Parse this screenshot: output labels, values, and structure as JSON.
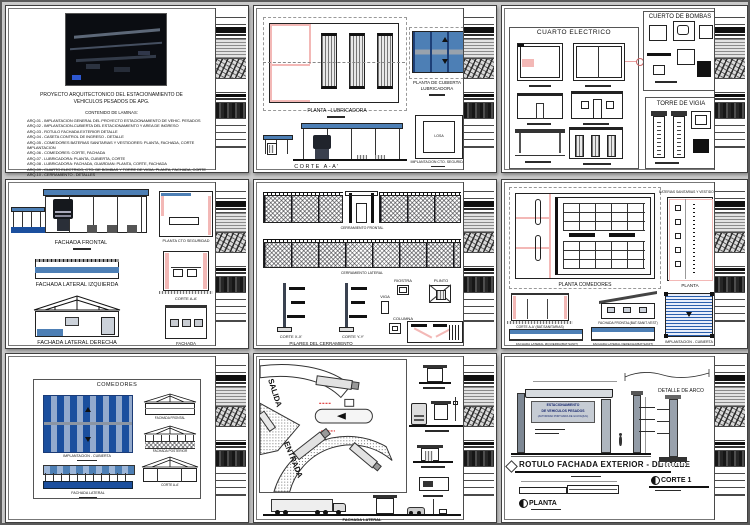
{
  "colors": {
    "roof_blue": "#4d7fb5",
    "stripe_dark": "#1b4f9e",
    "stripe_light": "#93aacd",
    "wall_pink": "#f3b8b6",
    "line": "#1a1a1a"
  },
  "s1": {
    "title1": "PROYECTO ARQUITECTONICO DEL ESTACIONAMIENTO DE",
    "title2": "VEHICULOS PESADOS DE APG.",
    "heading": "CONTENIDO DE LAMINAS:",
    "items": [
      "ARQ-01 - IMPLANTACION GENERAL DEL PROYECTO ESTACIONAMIENTO DE VEHIC. PESADOS",
      "ARQ-02 - IMPLANTACION-CUBIERTA DEL ESTACIONAMIENTO Y AREA DE INGRESO",
      "ARQ-03 - ROTULO FACHADA EXTERIOR DETALLE",
      "ARQ-04 - CASETA CONTROL DE INGRESO - DETALLE",
      "ARQ-05 - COMEDORES BATERIAS SANITARIAS Y VESTIDORES: PLANTA, FACHADA, CORTE IMPLANTACION",
      "ARQ-06 - COMEDORES: CORTE, FACHADA",
      "ARQ-07 - LUBRICADORA: PLANTA, CUBIERTA, CORTE",
      "ARQ-08 - LUBRICADORA: FACHADA, GUARDIAN: PLANTA, CORTE, FACHADA",
      "ARQ-09 - CUARTO ELECTRICO, CTO. DE BOMBAS Y TORRE DE VIGIA: PLANTA, FACHADA, CORTE",
      "ARQ-10 - CERRAMIENTO - DETALLES"
    ]
  },
  "s2": {
    "planta": "PLANTA - LUBRICADORA",
    "cub1": "PLANTA DE CUBIERTA",
    "cub2": "LUBRICADORA",
    "corte": "CORTE A-A'",
    "losa": "LOSA",
    "impl": "IMPLANTACION CTO. SEGURIDAD"
  },
  "s3": {
    "electrico": "CUARTO ELECTRICO",
    "bombas": "CUERTO DE BOMBAS",
    "vigia": "TORRE DE VIGIA"
  },
  "s4": {
    "frontal": "FACHADA FRONTAL",
    "izq": "FACHADA LATERAL IZQUIERDA",
    "der": "FACHADA LATERAL DERECHA",
    "planta": "PLANTA CTO SEGURIDAD",
    "corte": "CORTE A-A'",
    "fachada": "FACHADA"
  },
  "s5": {
    "cfrontal": "CERRAMIENTO FRONTAL",
    "clateral": "CERRAMIENTO LATERAL",
    "pilares": "PILARES DEL CERRAMIENTO",
    "cx": "CORTE X-X'",
    "cy": "CORTE Y-Y'",
    "riostra": "RIOSTRA",
    "viga": "VIGA",
    "plinto": "PLINTO",
    "columna": "COLUMNA"
  },
  "s6": {
    "planta": "PLANTA COMEDORES",
    "baterias": "BATERIAS SANITARIAS Y VESTIDORES",
    "planta2": "PLANTA",
    "corte": "CORTE A-A' (BAT.SANITARIAS)",
    "ffrontal": "FACHADA FRONTAL(BAT.SANIT-VEST)",
    "fizq": "FACHADA LATERAL IZQUIERDA(BAT.SANIT)",
    "fder": "FACHADA LATERAL DERECHA(BAT.SANIT)",
    "impl": "IMPLANTACION - CUBIERTA"
  },
  "s7": {
    "title": "COMEDORES",
    "impl": "IMPLANTACION - CUBIERTA",
    "ffrontal": "FACHADA FRONTAL",
    "fposterior": "FACHADA POSTERIOR",
    "corte": "CORTE A-A'",
    "flateral": "FACHADA LATERAL"
  },
  "s8": {
    "salida": "SALIDA",
    "entrada": "ENTRADA",
    "flateral": "FACHADA LATERAL"
  },
  "s9": {
    "title": "ROTULO FACHADA EXTERIOR - DETALLE",
    "sign1": "ESTACIONAMIENTO",
    "sign2": "DE VEHICULOS PESADOS",
    "sign3": "(AUTORIDAD PORTUARIA DE GUAYAQUIL)",
    "arco": "DETALLE DE ARCO",
    "corte": "CORTE 1",
    "planta": "PLANTA"
  }
}
